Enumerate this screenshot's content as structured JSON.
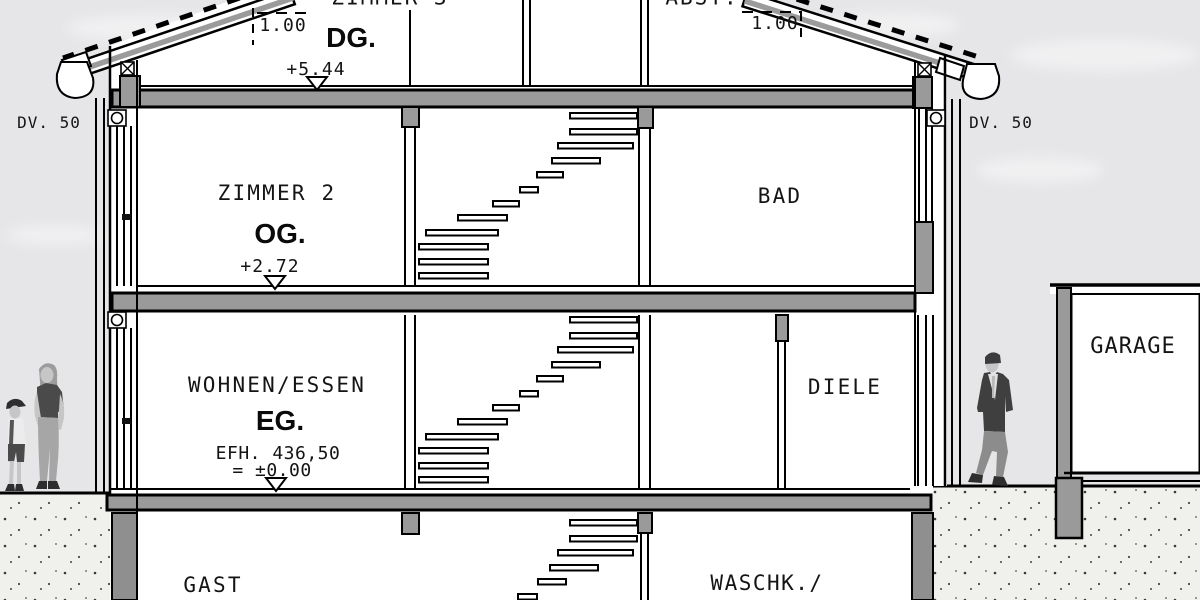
{
  "section": {
    "attic": {
      "room_left": "ZIMMER 3",
      "room_right": "ABST.",
      "floor": "DG.",
      "level": "+5.44"
    },
    "upper": {
      "room_left": "ZIMMER 2",
      "room_right": "BAD",
      "floor": "OG.",
      "level": "+2.72"
    },
    "ground": {
      "room_left": "WOHNEN/ESSEN",
      "room_right": "DIELE",
      "floor": "EG.",
      "level_ref": "EFH. 436,50",
      "level_zero": "= ±0.00"
    },
    "basement": {
      "room_left": "GAST",
      "room_right": "WASCHK./"
    },
    "garage": {
      "label": "GARAGE"
    },
    "dims": {
      "eaves_left": "DV. 50",
      "eaves_right": "DV. 50",
      "knee_left": "1.00",
      "knee_right": "1.00"
    }
  },
  "colors": {
    "sky": "#e6e6e8",
    "cloud": "#f2f2f3",
    "slab": "#9a9a9a",
    "basement_wall": "#8f8f8f",
    "earth": "#f0f0ec",
    "ink": "#111111"
  }
}
